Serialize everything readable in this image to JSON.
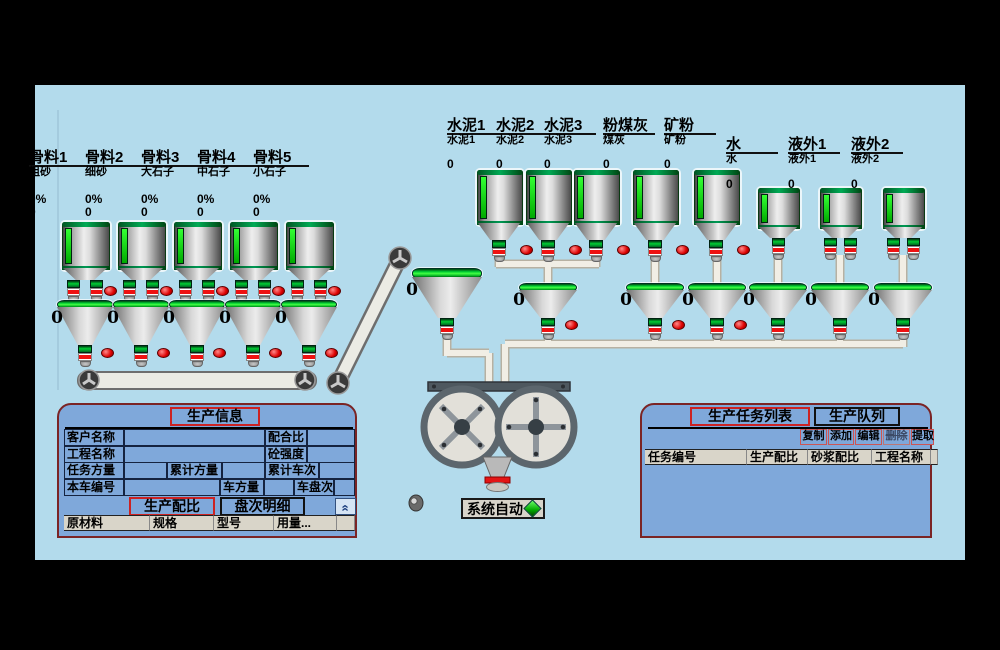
{
  "status": {
    "label": "系统自动"
  },
  "silos": {
    "aggregates": [
      {
        "name": "骨料1",
        "material": "粗砂",
        "percent": "0%",
        "value": "0",
        "hopper_value": "0"
      },
      {
        "name": "骨料2",
        "material": "细砂",
        "percent": "0%",
        "value": "0",
        "hopper_value": "0"
      },
      {
        "name": "骨料3",
        "material": "大石子",
        "percent": "0%",
        "value": "0",
        "hopper_value": "0"
      },
      {
        "name": "骨料4",
        "material": "中石子",
        "percent": "0%",
        "value": "0",
        "hopper_value": "0"
      },
      {
        "name": "骨料5",
        "material": "小石子",
        "percent": "0%",
        "value": "0",
        "hopper_value": "0"
      }
    ],
    "powders": [
      {
        "name": "水泥1",
        "material": "水泥1",
        "value": "0"
      },
      {
        "name": "水泥2",
        "material": "水泥2",
        "value": "0"
      },
      {
        "name": "水泥3",
        "material": "水泥3",
        "value": "0"
      },
      {
        "name": "粉煤灰",
        "material": "煤灰",
        "value": "0"
      },
      {
        "name": "矿粉",
        "material": "矿粉",
        "value": "0"
      }
    ],
    "liquids": [
      {
        "name": "水",
        "material": "水",
        "value": "0"
      },
      {
        "name": "液外1",
        "material": "液外1",
        "value": "0"
      },
      {
        "name": "液外2",
        "material": "液外2",
        "value": "0"
      }
    ]
  },
  "weigh_hoppers": [
    {
      "value": "0"
    },
    {
      "value": "0"
    },
    {
      "value": "0"
    },
    {
      "value": "0"
    },
    {
      "value": "0"
    },
    {
      "value": "0"
    }
  ],
  "receiving_funnel": {
    "value": "0"
  },
  "info_panel": {
    "title": "生产信息",
    "rows": [
      [
        "客户名称",
        "",
        "配合比",
        ""
      ],
      [
        "工程名称",
        "",
        "砼强度",
        ""
      ],
      [
        "任务方量",
        "",
        "累计方量",
        "",
        "累计车次",
        ""
      ],
      [
        "本车编号",
        "",
        "车方量",
        "",
        "车盘次",
        ""
      ]
    ],
    "tabs": [
      "生产配比",
      "盘次明细"
    ],
    "collapse": "«",
    "headers": [
      "原材料",
      "规格",
      "型号",
      "用量...",
      ""
    ]
  },
  "task_panel": {
    "tabs": [
      "生产任务列表",
      "生产队列"
    ],
    "buttons": [
      {
        "label": "复制",
        "disabled": false
      },
      {
        "label": "添加",
        "disabled": false
      },
      {
        "label": "编辑",
        "disabled": false
      },
      {
        "label": "删除",
        "disabled": true
      },
      {
        "label": "提取",
        "disabled": false
      }
    ],
    "headers": [
      "任务编号",
      "生产配比",
      "砂浆配比",
      "工程名称",
      ""
    ]
  },
  "colors": {
    "screen_bg": "#b3dbec",
    "panel_bg": "#7fa8da",
    "panel_border": "#7b2424",
    "table_header_bg": "#d9d5c9",
    "alarm_red": "#dd0000",
    "level_green": "#00cc00",
    "pipe": "#f1eee5"
  }
}
